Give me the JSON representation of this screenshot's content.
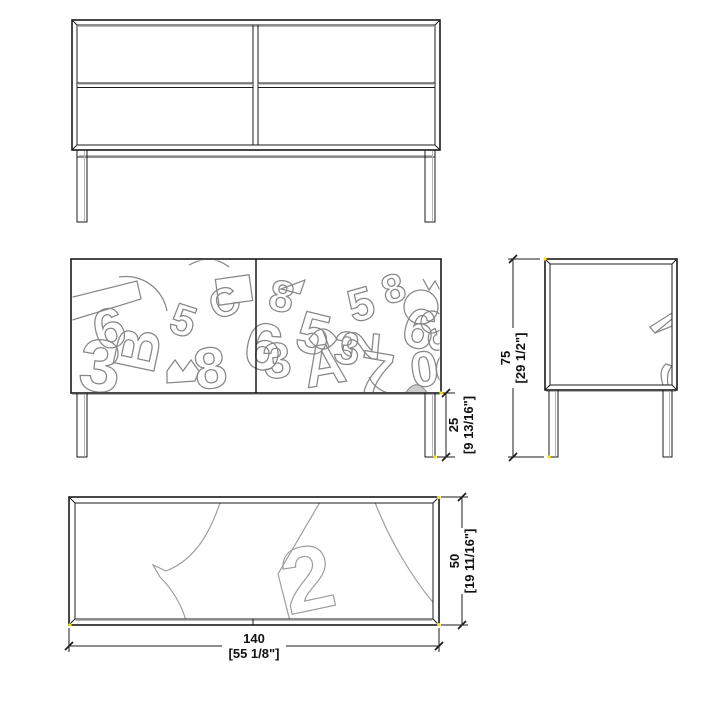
{
  "drawing": {
    "type": "furniture-technical-drawing",
    "subject": "sideboard with two doors, doodle-pattern front, metal legs"
  },
  "colors": {
    "background": "#ffffff",
    "line": "#1b1b1b",
    "pattern": "#878787",
    "plan_pattern": "#9e9e9e",
    "shade_fill": "#cccccc",
    "snap_marker": "#ffe400"
  },
  "dimensions": {
    "leg_height": {
      "value": "25",
      "imperial": "[9 13/16\"]"
    },
    "total_height": {
      "value": "75",
      "imperial": "[29 1/2\"]"
    },
    "depth": {
      "value": "50",
      "imperial": "[19 11/16\"]"
    },
    "width": {
      "value": "140",
      "imperial": "[55 1/8\"]"
    }
  },
  "artwork": {
    "front_doodle_glyphs": [
      {
        "char": "6",
        "x": 28,
        "y": 92,
        "size": 56,
        "rot": -15
      },
      {
        "char": "3",
        "x": 6,
        "y": 130,
        "size": 74,
        "rot": 6
      },
      {
        "char": "B",
        "x": 82,
        "y": 116,
        "size": 60,
        "rot": -78
      },
      {
        "char": "5",
        "x": 96,
        "y": 72,
        "size": 44,
        "rot": 18
      },
      {
        "char": "8",
        "x": 126,
        "y": 131,
        "size": 58,
        "rot": -8
      },
      {
        "char": "6",
        "x": 170,
        "y": 106,
        "size": 66,
        "rot": 12
      },
      {
        "char": "C",
        "x": 146,
        "y": 62,
        "size": 40,
        "rot": -25
      },
      {
        "char": "8",
        "x": 196,
        "y": 50,
        "size": 44,
        "rot": 10
      },
      {
        "char": "3",
        "x": 194,
        "y": 120,
        "size": 50,
        "rot": -6
      },
      {
        "char": "5",
        "x": 222,
        "y": 90,
        "size": 58,
        "rot": 14
      },
      {
        "char": "A",
        "x": 236,
        "y": 129,
        "size": 58,
        "rot": -10
      },
      {
        "char": "3",
        "x": 262,
        "y": 104,
        "size": 46,
        "rot": 4
      },
      {
        "char": "5",
        "x": 282,
        "y": 64,
        "size": 46,
        "rot": -16
      },
      {
        "char": "7",
        "x": 284,
        "y": 133,
        "size": 62,
        "rot": 10
      },
      {
        "char": "2",
        "x": 306,
        "y": 102,
        "size": 52,
        "rot": -85
      },
      {
        "char": "6",
        "x": 328,
        "y": 84,
        "size": 56,
        "rot": 16
      },
      {
        "char": "0",
        "x": 342,
        "y": 129,
        "size": 50,
        "rot": -8
      },
      {
        "char": "8",
        "x": 316,
        "y": 46,
        "size": 40,
        "rot": -18
      },
      {
        "char": "3",
        "x": 356,
        "y": 70,
        "size": 44,
        "rot": 80
      }
    ],
    "plan_glyph": {
      "char": "2",
      "x": 214,
      "y": 112,
      "size": 92,
      "rot": -12
    }
  }
}
